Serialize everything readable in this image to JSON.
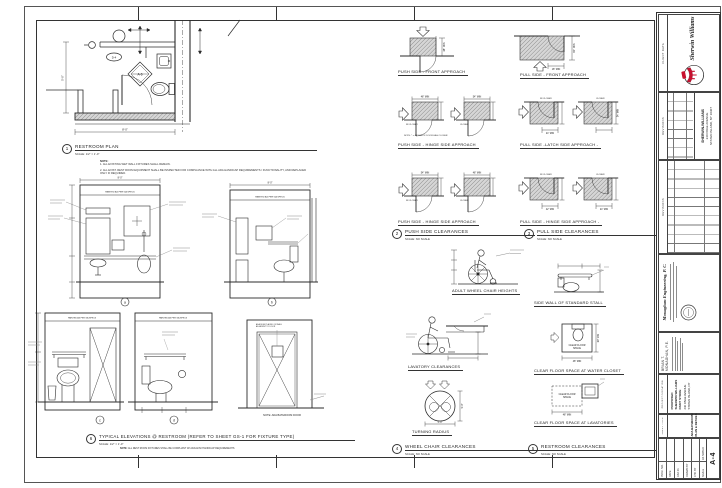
{
  "sheet": {
    "paper": "#ffffff",
    "ink": "#222222",
    "accent_red": "#c8102e"
  },
  "plan": {
    "number": "1",
    "title": "RESTROOM PLAN",
    "scale": "SCALE: 1/2\" = 1'-0\"",
    "note_heading": "NOTE:",
    "note1": "1.  ALL EXISTING WET WALL FIXTURES SHALL REMAIN.",
    "note2": "2.  ALL EXIST. REST ROOM EQUIPMENT SHALL BE INSPECTED FOR COMPLIANCE WITH ALL ADA HANDICAP REQUIREMENTS / FUNCTIONALITY, AND REPLACED ONLY IF REQUIRED.",
    "detail_tag": "A-6",
    "door_tag": "D-4",
    "dim_a": "8'-0\"",
    "dim_b": "5'-0\""
  },
  "elev": {
    "number": "6",
    "title": "TYPICAL ELEVATIONS @ RESTROOM (REFER TO SHEET GS-1 FOR FIXTURE TYPE)",
    "scale": "SCALE: 1/2\" = 1'-0\"",
    "note_heading": "NOTE:",
    "note": "ALL REST ROOM FIXTURES SHALL BE COMPLIANT W/ ADA/ANSI HANDICAP REQUIREMENTS",
    "band": "PAINTED AS PER GA SPECS",
    "la": "a",
    "lb": "b",
    "lc": "c",
    "ld": "d",
    "door_note": "NOTE: ADA BATHROOM DOOR",
    "sign_note": "ADA SIGN PLACED ON WALL ADJACENT TO DOOR",
    "dim_a": "8'-0\""
  },
  "doors": {
    "g2num": "2",
    "g2title": "PUSH SIDE CLEARANCES",
    "g3num": "3",
    "g3title": "PULL SIDE CLEARANCES",
    "noscale": "SCALE: NO SCALE",
    "c1": "PUSH SIDE - FRONT APPROACH",
    "c2": "PULL SIDE - FRONT APPROACH",
    "c3": "PUSH SIDE - HINGE SIDE APPROACH",
    "c4": "PULL SIDE -LATCH SIDE APPROACH -",
    "c5": "PUSH SIDE - HINGE SIDE APPROACH",
    "c6": "PULL SIDE - HINGE SIDE APPROACH -",
    "d48": "48\" MIN",
    "d54": "54\" MIN",
    "d60": "60\" MIN",
    "d18": "18\" MIN",
    "d24": "24\" MIN",
    "d42": "42\" MIN",
    "wcl": "W/ CLOSER",
    "cl": "CLOSER",
    "note": "NOTE: * = 48\" MIN. IF DOOR HAS CLOSER"
  },
  "wc": {
    "g4num": "4",
    "g4title": "WHEEL CHAIR CLEARANCES",
    "g5num": "5",
    "g5title": "RESTROOM CLEARANCES",
    "adult": "ADULT WHEEL CHAIR HEIGHTS",
    "lavatory": "LAVATORY CLEARANCES",
    "turning": "TURNING RADIUS",
    "stall": "SIDE WALL OF STANDARD STALL",
    "wcspace": "CLEAR FLOOR SPACE AT WATER CLOSET",
    "lavspace": "CLEAR FLOOR SPACE AT LAVATORIES",
    "clear": "CLEAR FLOOR",
    "clear2": "SPACE",
    "d50": "5'-0\""
  },
  "tb": {
    "client_label": "CLIENT DATA",
    "client_name": "Sherwin Williams",
    "revisions_label": "REVISIONS",
    "address1": "SHERWIN-WILLIAMS",
    "address2": "240 PAGE AVENUE",
    "address3": "STATEN ISLAND, NY 10307",
    "engineer": "Monaghan Engineering, P. C.",
    "pe1": "BRIAN  T.",
    "pe2": "MONAGHAN,  P.E.",
    "project_label": "PROJECT/LOCATION",
    "proj1": "PROPOSED",
    "proj2": "SHERWIN WILLIAMS",
    "proj3": "PAINT STORE",
    "proj4": "240 PAGE AVENUE",
    "proj5": "STATEN ISLAND, NY",
    "sheet_label": "SHEET TITLE",
    "sheet1": "ADA BATHROOM",
    "sheet2": "PLAN & DETAILS",
    "f1": "PROJ. NO.",
    "f2": "DATE",
    "f3": "CAD ID.",
    "f4": "DRAWN BY",
    "f5": "CHK BY",
    "f6": "SCALE",
    "f6v": "AS NOTED",
    "sheet_no": "A-4"
  }
}
